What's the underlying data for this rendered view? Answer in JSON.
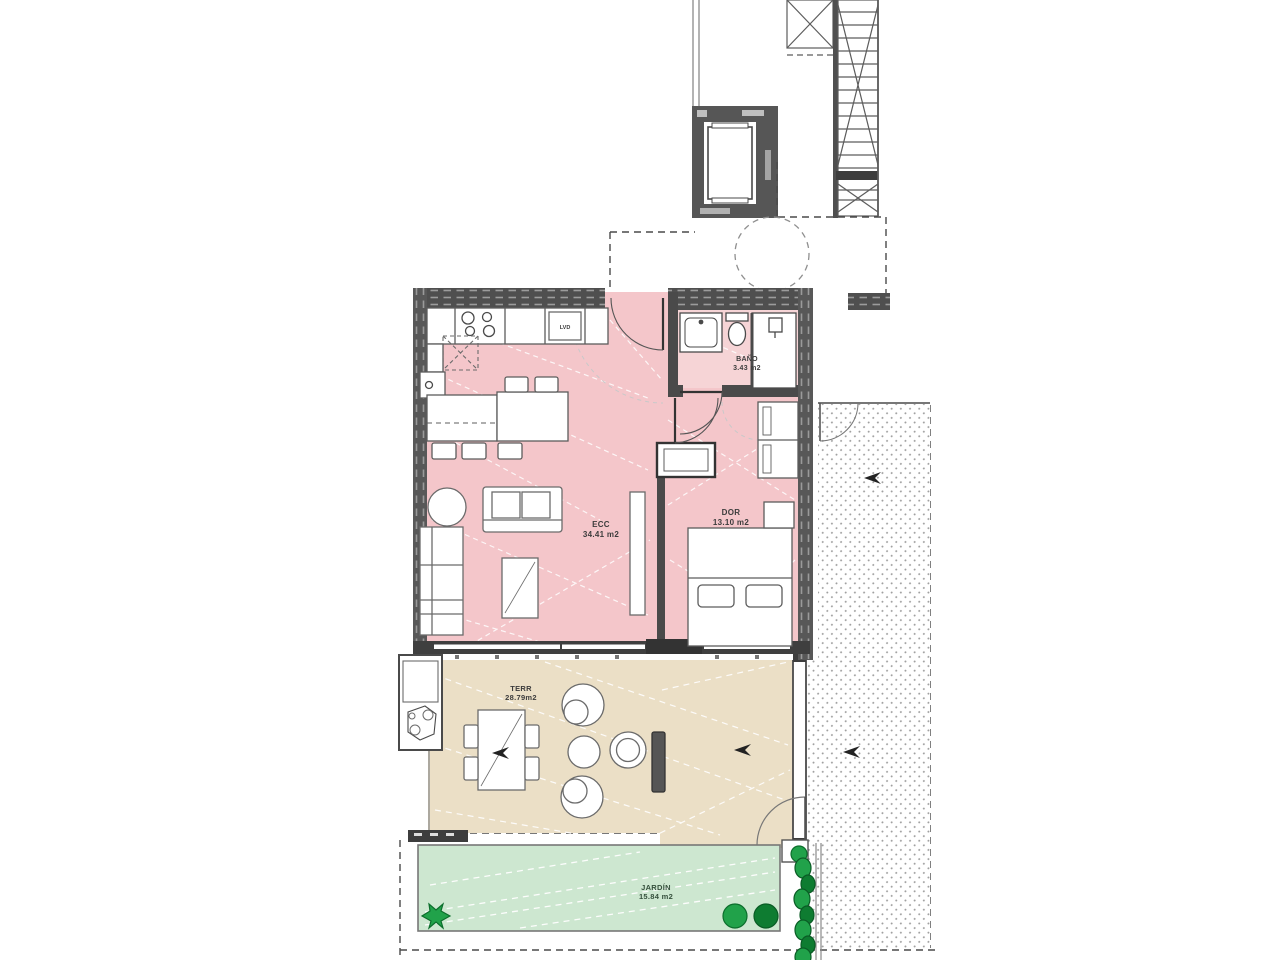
{
  "rooms": {
    "living": {
      "name": "ECC",
      "area": "34.41 m2"
    },
    "bedroom": {
      "name": "DOR",
      "area": "13.10 m2"
    },
    "bathroom": {
      "name": "BAÑO",
      "area": "3.43 m2"
    },
    "terrace": {
      "name": "TERR",
      "area": "28.79m2"
    },
    "garden": {
      "name": "JARDÍN",
      "area": "15.84 m2"
    }
  },
  "appliances": {
    "washer": "LVD"
  },
  "colors": {
    "interior": "#f4c6ca",
    "bath": "#f6d4d6",
    "terrace": "#ebdfc6",
    "garden": "#cde7d0",
    "wall": "#4f4f4f",
    "tree": "#21a24a",
    "treeDark": "#0e7c31"
  }
}
